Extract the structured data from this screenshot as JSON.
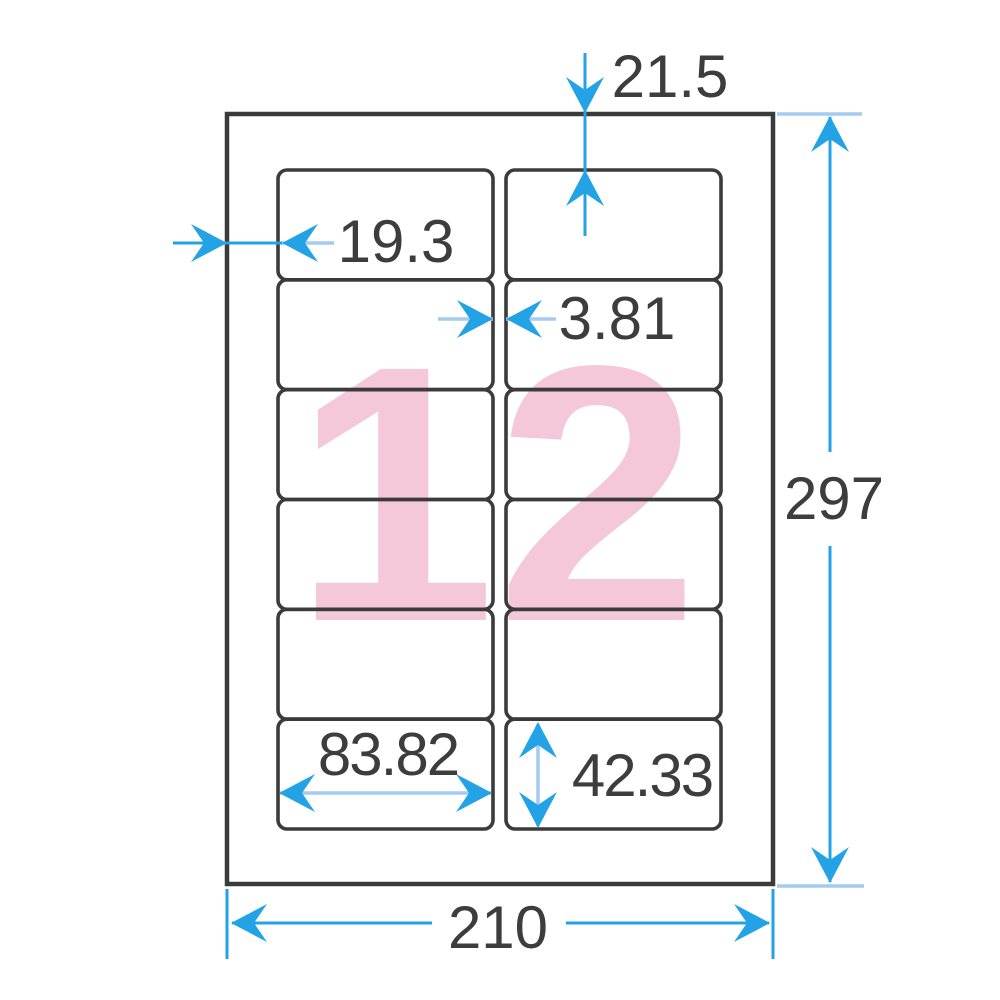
{
  "diagram": {
    "type": "label-sheet-dimension-diagram",
    "values": {
      "sheet_width": "210",
      "sheet_height": "297",
      "top_margin": "21.5",
      "left_margin": "19.3",
      "column_gap": "3.81",
      "label_width": "83.82",
      "label_height": "42.33",
      "label_count": "12"
    },
    "grid": {
      "columns": 2,
      "rows": 6
    },
    "colors": {
      "outline": "#3b3b3b",
      "dimension_blue": "#23a2e6",
      "dimension_light_blue": "#a4cbf1",
      "count_pink": "#f4c7d9"
    }
  }
}
